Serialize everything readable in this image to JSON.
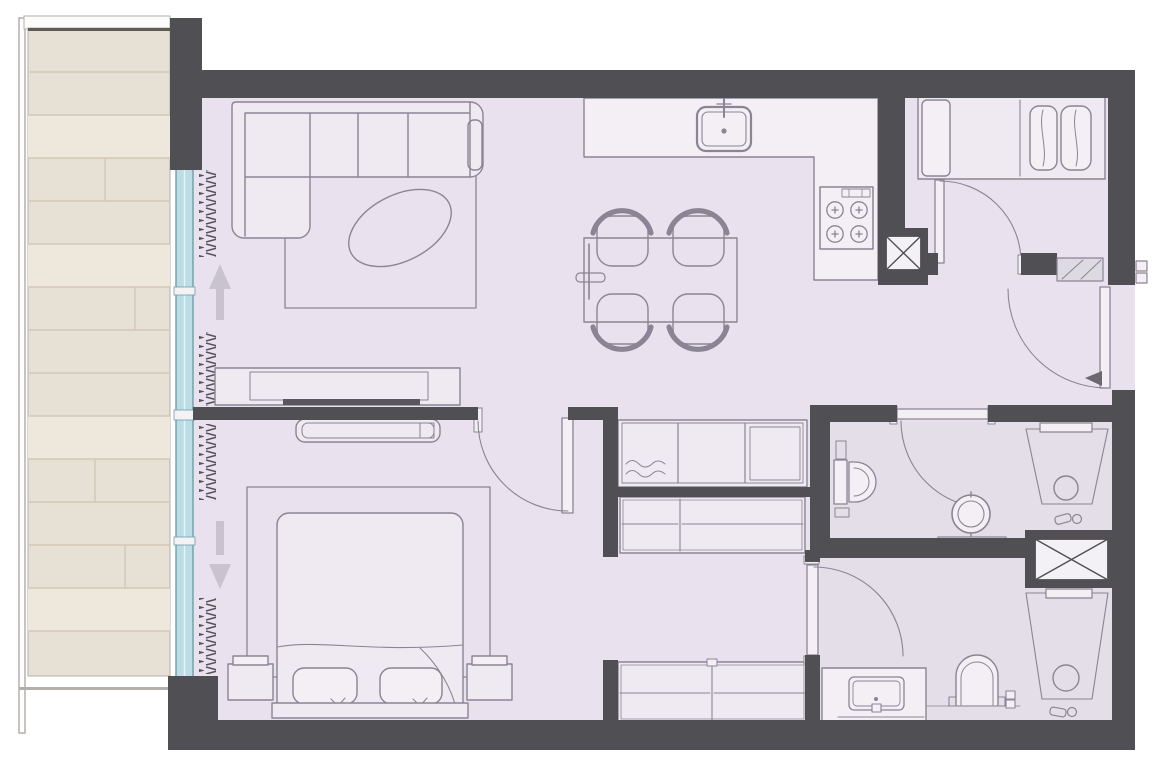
{
  "document": {
    "type": "architectural-floor-plan",
    "view": "top-down-2d",
    "visible_text": "none",
    "width_px": 1158,
    "height_px": 759
  },
  "palette": {
    "background": "#ffffff",
    "wall": "#504f54",
    "floor": "#e9e2ee",
    "floor_bathroom": "#e4dee8",
    "furniture_line": "#8b8494",
    "furniture_fill": "#efeaf2",
    "counter_fill": "#f3eff5",
    "tv": "#5a5560",
    "window_glass": "#bcdde6",
    "window_frame": "#6f9dab",
    "window_divider": "#e8f3f6",
    "mullion": "#f4f2f4",
    "balcony_wood": "#e7e0d4",
    "balcony_wood_light": "#eee8dc",
    "balcony_wood_line": "#d2c8b6",
    "balcony_edge": "#5f5b56",
    "parapet_fill": "#fcfcfb",
    "parapet_line": "#b3afab",
    "curtain": "#55525a",
    "arrow": "#c9c3d0",
    "shaft_fill": "#f4f1f6",
    "hatch_fill": "#dedae2",
    "entry_arrow": "#6b6870"
  },
  "rooms": [
    {
      "id": "balcony",
      "position": "left",
      "features": [
        "wood-plank-deck",
        "parapet",
        "full-height-glazing",
        "curtain-symbols"
      ],
      "slide_direction_arrows": 2
    },
    {
      "id": "living-room",
      "position": "top-left",
      "furniture": [
        "l-shaped-sectional-sofa",
        "area-rug",
        "oval-coffee-table",
        "tv-console",
        "wall-tv"
      ]
    },
    {
      "id": "dining-area",
      "position": "center",
      "furniture": [
        "dining-table",
        "dining-chair"
      ],
      "chair_count": 4
    },
    {
      "id": "kitchen",
      "position": "top-center",
      "fixtures": [
        "l-shaped-counter",
        "sink-with-faucet",
        "cooktop"
      ],
      "burner_count": 4
    },
    {
      "id": "master-bedroom",
      "position": "bottom-left",
      "furniture": [
        "double-bed",
        "pillow",
        "nightstand",
        "area-rug",
        "bench-console",
        "headboard",
        "swing-door"
      ],
      "pillow_count": 2,
      "nightstand_count": 2
    },
    {
      "id": "dressing-area",
      "position": "center-bottom",
      "furniture": [
        "hall-closet-3-sections",
        "wardrobe-2-sections",
        "wardrobe-2-sections"
      ]
    },
    {
      "id": "second-bedroom",
      "position": "top-right",
      "furniture": [
        "single-bed",
        "footboard",
        "bolster-pillows",
        "swing-door"
      ],
      "pillow_count": 2
    },
    {
      "id": "entry-hall",
      "position": "right",
      "fixtures": [
        "entrance-swing-door",
        "hatched-threshold",
        "exterior-door-marks",
        "entry-direction-arrow"
      ]
    },
    {
      "id": "bathroom-upper",
      "position": "right-middle",
      "fixtures": [
        "toilet-with-cistern",
        "round-pedestal-basin",
        "walk-in-shower",
        "shower-drain",
        "swing-door"
      ]
    },
    {
      "id": "bathroom-lower",
      "position": "bottom-right",
      "fixtures": [
        "vanity-with-basin",
        "toilet",
        "walk-in-shower",
        "shower-drain",
        "swing-door"
      ]
    },
    {
      "id": "service-shafts",
      "position": "right",
      "symbol": "box-with-diagonal-cross",
      "count": 2
    }
  ]
}
